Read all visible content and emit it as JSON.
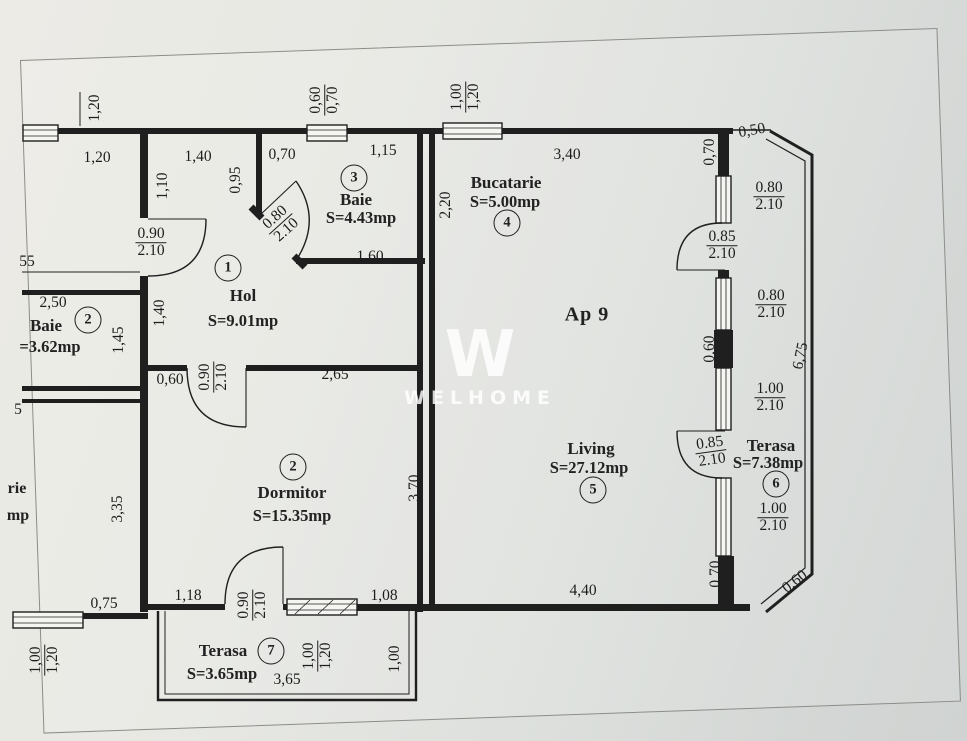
{
  "watermark": {
    "mark": "W",
    "word": "WELHOME"
  },
  "apartment": {
    "label": "Ap 9",
    "x": 587,
    "y": 315
  },
  "rooms": [
    {
      "number": "1",
      "name": "Hol",
      "area": "S=9.01mp",
      "cx": 228,
      "cy": 268,
      "nx": 243,
      "ny": 296,
      "ax": 243,
      "ay": 321
    },
    {
      "number": "2",
      "name": "Baie",
      "area": "=3.62mp",
      "cx": 88,
      "cy": 320,
      "nx": 46,
      "ny": 326,
      "ax": 50,
      "ay": 347
    },
    {
      "number": "3",
      "name": "Baie",
      "area": "S=4.43mp",
      "cx": 354,
      "cy": 178,
      "nx": 356,
      "ny": 200,
      "ax": 361,
      "ay": 218
    },
    {
      "number": "4",
      "name": "Bucatarie",
      "area": "S=5.00mp",
      "cx": 507,
      "cy": 223,
      "nx": 506,
      "ny": 183,
      "ax": 505,
      "ay": 202
    },
    {
      "number": "5",
      "name": "Living",
      "area": "S=27.12mp",
      "cx": 593,
      "cy": 490,
      "nx": 591,
      "ny": 449,
      "ax": 589,
      "ay": 468
    },
    {
      "number": "6",
      "name": "Terasa",
      "area": "S=7.38mp",
      "cx": 776,
      "cy": 484,
      "nx": 771,
      "ny": 446,
      "ax": 768,
      "ay": 463
    },
    {
      "number": "2",
      "name": "Dormitor",
      "area": "S=15.35mp",
      "cx": 293,
      "cy": 467,
      "nx": 292,
      "ny": 493,
      "ax": 292,
      "ay": 516
    },
    {
      "number": "7",
      "name": "Terasa",
      "area": "S=3.65mp",
      "cx": 271,
      "cy": 651,
      "nx": 223,
      "ny": 651,
      "ax": 222,
      "ay": 674
    }
  ],
  "partials": [
    {
      "t": "rie",
      "x": 17,
      "y": 489
    },
    {
      "t": "mp",
      "x": 18,
      "y": 516
    }
  ],
  "dimensions": [
    {
      "t": "1,20",
      "x": 95,
      "y": 108,
      "r": -90
    },
    {
      "t": "1,20",
      "x": 97,
      "y": 158,
      "r": 0
    },
    {
      "t": "1,40",
      "x": 198,
      "y": 157,
      "r": 0
    },
    {
      "t": "1,10",
      "x": 163,
      "y": 186,
      "r": -90
    },
    {
      "t": "0,95",
      "x": 236,
      "y": 180,
      "r": -90
    },
    {
      "t": "0,70",
      "x": 282,
      "y": 155,
      "r": 0
    },
    {
      "t": "1,15",
      "x": 383,
      "y": 151,
      "r": 0
    },
    {
      "t": "1,60",
      "x": 370,
      "y": 257,
      "r": 0
    },
    {
      "t": "2,20",
      "x": 446,
      "y": 205,
      "r": -90
    },
    {
      "t": "3,40",
      "x": 567,
      "y": 155,
      "r": 0
    },
    {
      "t": "0,50",
      "x": 752,
      "y": 131,
      "r": -10
    },
    {
      "t": "0,70",
      "x": 710,
      "y": 152,
      "r": -90
    },
    {
      "t": "55",
      "x": 27,
      "y": 262,
      "r": 0
    },
    {
      "t": "2,50",
      "x": 53,
      "y": 303,
      "r": 0
    },
    {
      "t": "1,45",
      "x": 119,
      "y": 340,
      "r": -90
    },
    {
      "t": "1,40",
      "x": 160,
      "y": 313,
      "r": -90
    },
    {
      "t": "0,60",
      "x": 170,
      "y": 380,
      "r": 0
    },
    {
      "t": "5",
      "x": 18,
      "y": 410,
      "r": 0
    },
    {
      "t": "3,35",
      "x": 118,
      "y": 509,
      "r": -90
    },
    {
      "t": "0,75",
      "x": 104,
      "y": 604,
      "r": 0
    },
    {
      "t": "2,65",
      "x": 335,
      "y": 375,
      "r": 0
    },
    {
      "t": "3,70",
      "x": 415,
      "y": 488,
      "r": -90
    },
    {
      "t": "0,60",
      "x": 710,
      "y": 349,
      "r": -90
    },
    {
      "t": "6,75",
      "x": 801,
      "y": 356,
      "r": -78
    },
    {
      "t": "1,18",
      "x": 188,
      "y": 596,
      "r": 0
    },
    {
      "t": "1,08",
      "x": 384,
      "y": 596,
      "r": 0
    },
    {
      "t": "4,40",
      "x": 583,
      "y": 591,
      "r": 0
    },
    {
      "t": "0,70",
      "x": 716,
      "y": 574,
      "r": -90
    },
    {
      "t": "0,60",
      "x": 795,
      "y": 582,
      "r": -38
    },
    {
      "t": "3,65",
      "x": 287,
      "y": 680,
      "r": 0
    },
    {
      "t": "1,00",
      "x": 395,
      "y": 659,
      "r": -90
    },
    {
      "t": "0,60",
      "b": "0,70",
      "x": 325,
      "y": 100,
      "r": -90
    },
    {
      "t": "1,00",
      "b": "1,20",
      "x": 466,
      "y": 97,
      "r": -90
    },
    {
      "t": "0.90",
      "b": "2.10",
      "x": 151,
      "y": 243,
      "r": 0
    },
    {
      "t": "0.80",
      "b": "2.10",
      "x": 281,
      "y": 224,
      "r": -42
    },
    {
      "t": "0.85",
      "b": "2.10",
      "x": 722,
      "y": 246,
      "r": 0
    },
    {
      "t": "0.80",
      "b": "2.10",
      "x": 769,
      "y": 197,
      "r": 0
    },
    {
      "t": "0.80",
      "b": "2.10",
      "x": 771,
      "y": 305,
      "r": 0
    },
    {
      "t": "1.00",
      "b": "2.10",
      "x": 770,
      "y": 398,
      "r": 0
    },
    {
      "t": "0.85",
      "b": "2.10",
      "x": 711,
      "y": 452,
      "r": -8
    },
    {
      "t": "1.00",
      "b": "2.10",
      "x": 773,
      "y": 518,
      "r": 0
    },
    {
      "t": "0.90",
      "b": "2.10",
      "x": 214,
      "y": 377,
      "r": -90
    },
    {
      "t": "0.90",
      "b": "2.10",
      "x": 253,
      "y": 605,
      "r": -90
    },
    {
      "t": "1,00",
      "b": "1,20",
      "x": 318,
      "y": 656,
      "r": -90
    },
    {
      "t": "1,00",
      "b": "1,20",
      "x": 45,
      "y": 660,
      "r": -90
    }
  ]
}
